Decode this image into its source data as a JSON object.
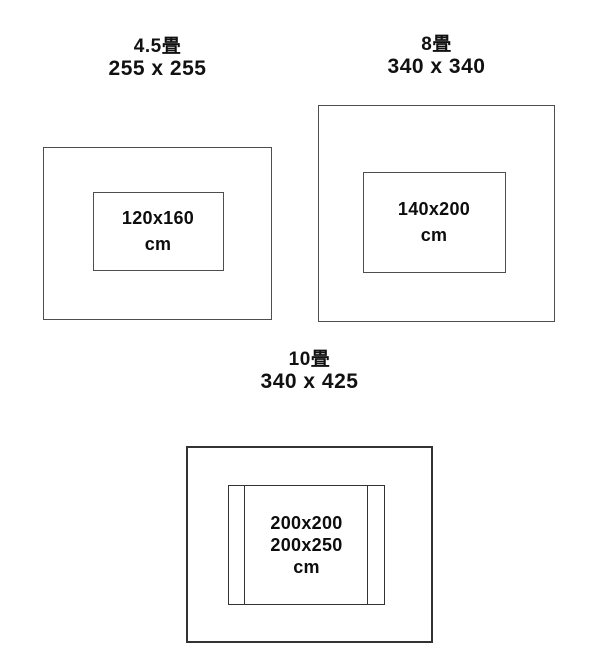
{
  "colors": {
    "background": "#ffffff",
    "line": "#4e4e4e",
    "line_dark": "#333333",
    "text": "#111111"
  },
  "diagrams": [
    {
      "tatami_label": "4.5畳",
      "room_dimensions": "255 x 255",
      "rug_sizes": [
        "120x160",
        "cm"
      ]
    },
    {
      "tatami_label": "8畳",
      "room_dimensions": "340 x 340",
      "rug_sizes": [
        "140x200",
        "cm"
      ]
    },
    {
      "tatami_label": "10畳",
      "room_dimensions": "340 x 425",
      "rug_sizes": [
        "200x200",
        "200x250",
        "cm"
      ]
    }
  ]
}
